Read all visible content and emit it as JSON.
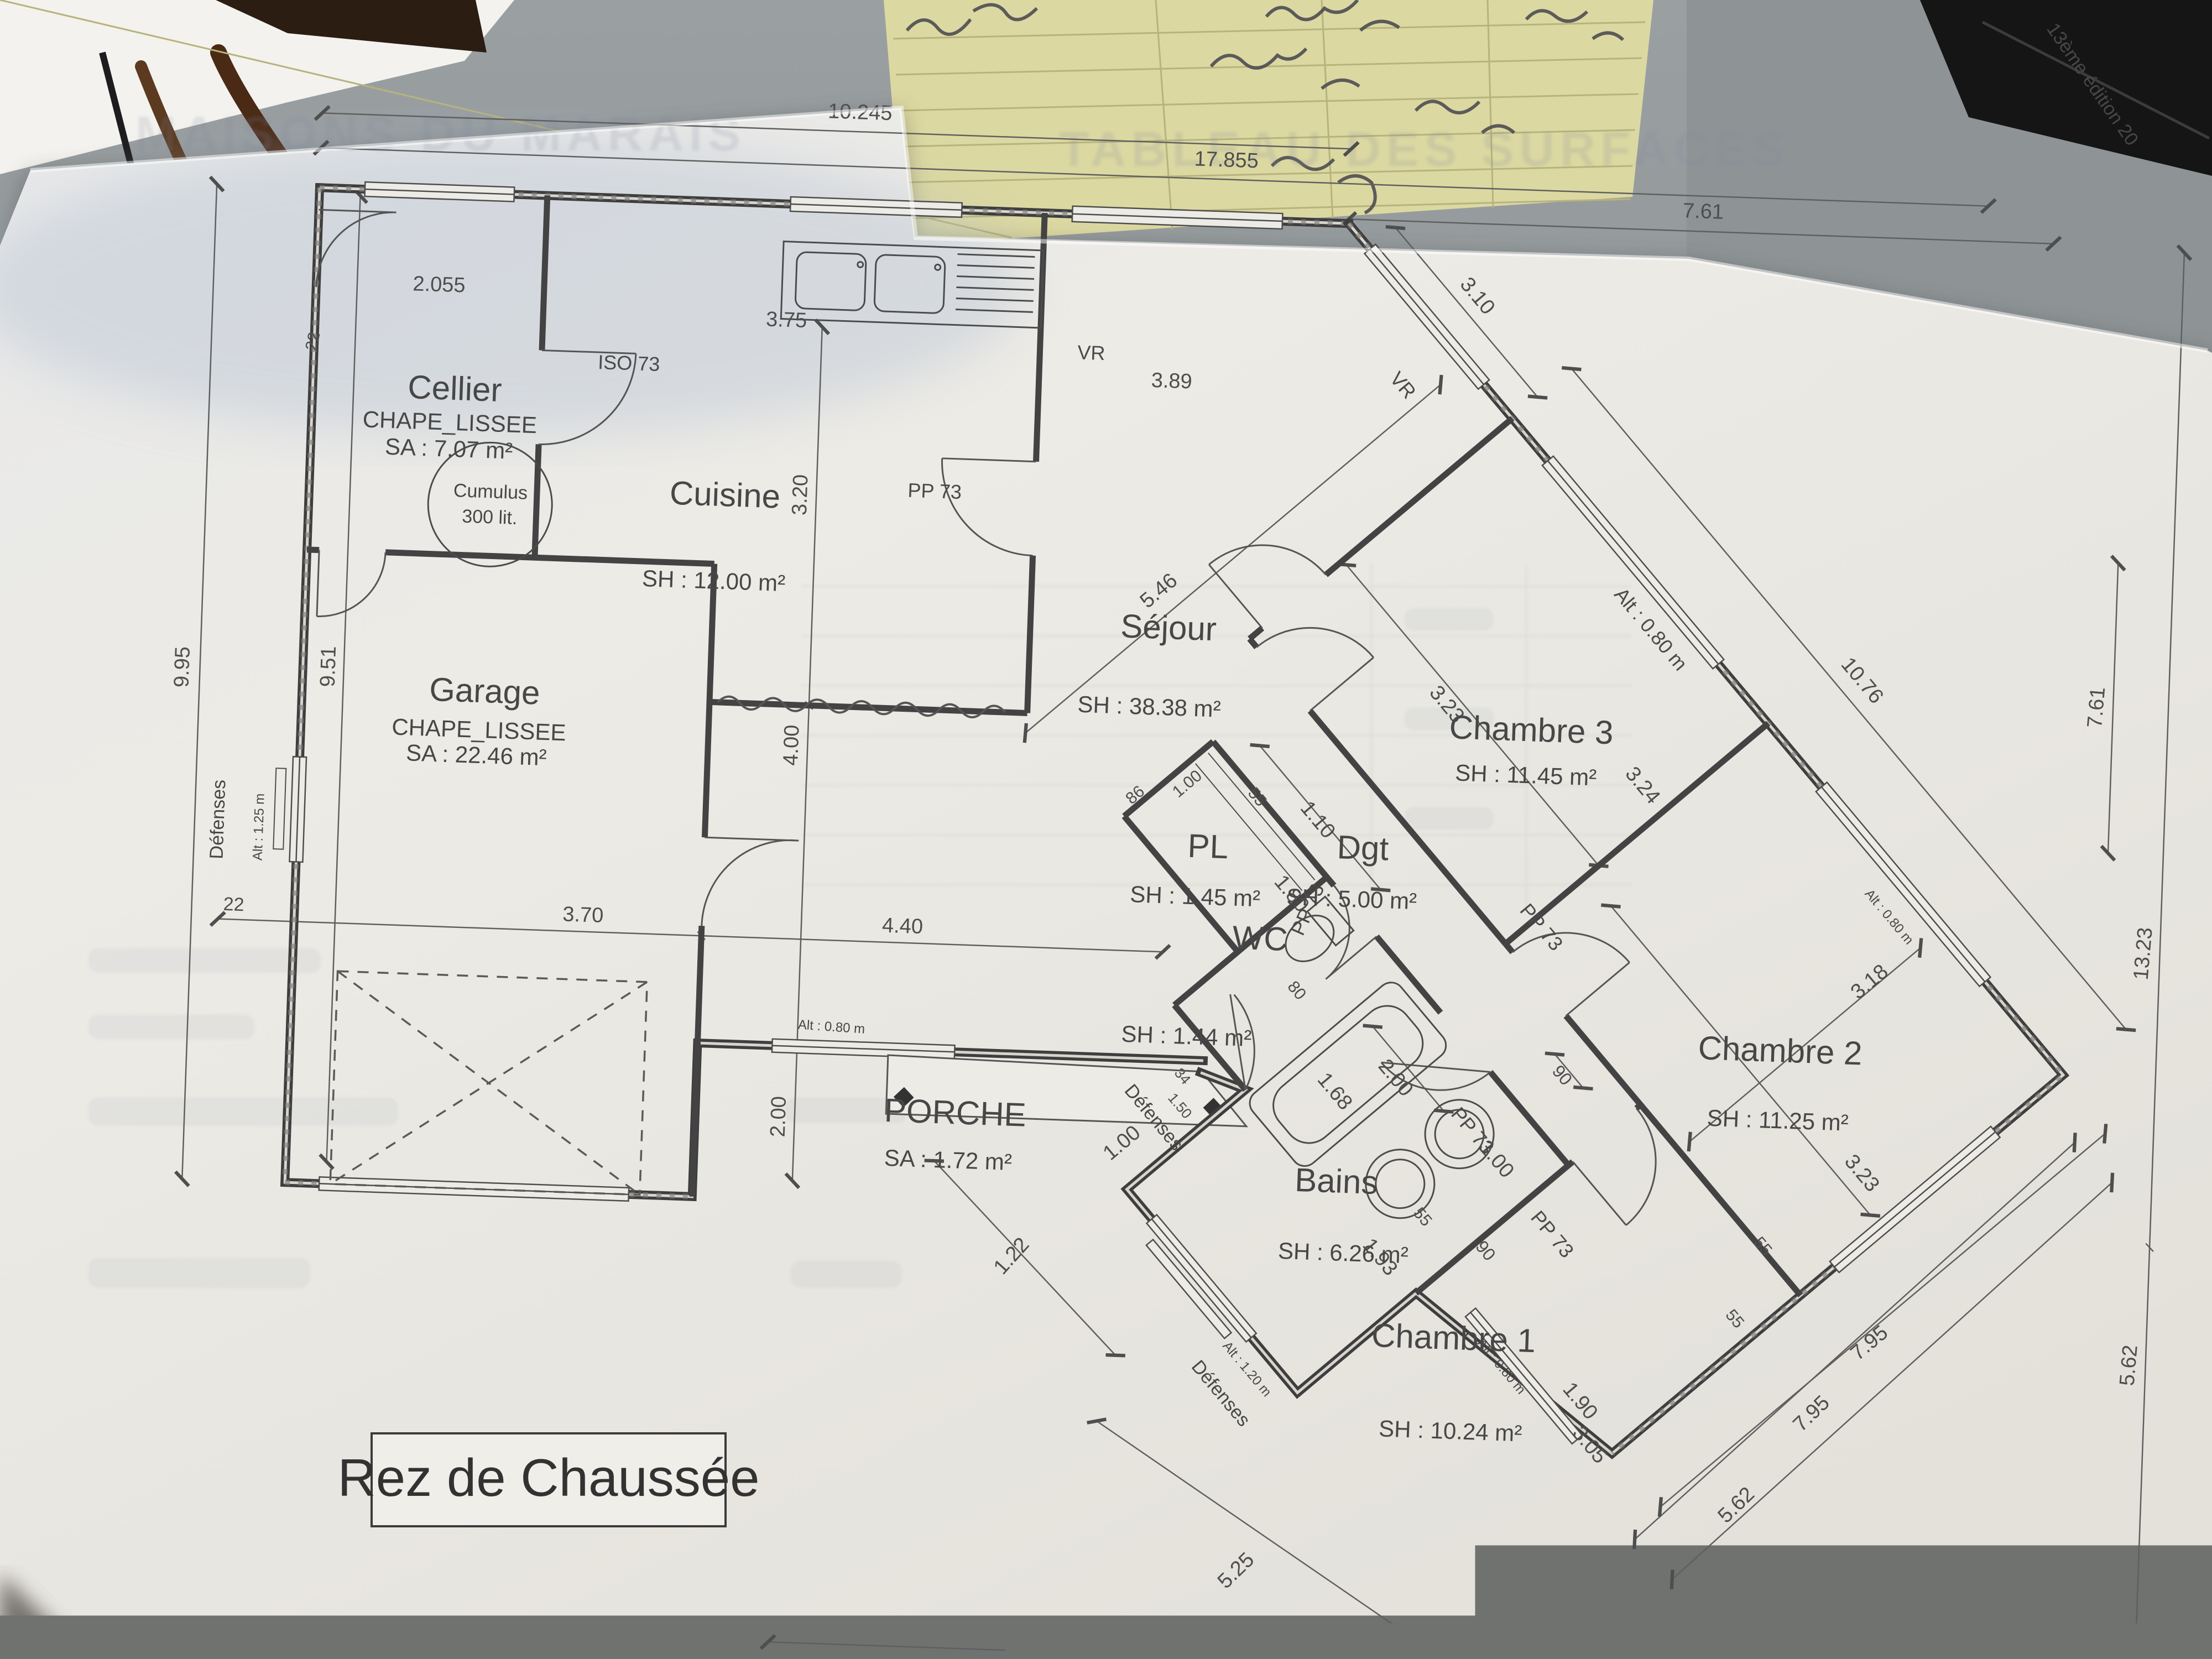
{
  "scene": {
    "bleed_left": "MAISONS DU MARAIS",
    "bleed_right": "TABLEAU DES SURFACES",
    "book_spine": "13ème édition 20"
  },
  "title_box": {
    "label": "Rez de Chaussée"
  },
  "rooms": {
    "cellier": {
      "name": "Cellier",
      "finish": "CHAPE_LISSEE",
      "area": "SA : 7.07 m²"
    },
    "cuisine": {
      "name": "Cuisine",
      "area": "SH : 12.00 m²"
    },
    "sejour": {
      "name": "Séjour",
      "area": "SH : 38.38 m²"
    },
    "garage": {
      "name": "Garage",
      "finish": "CHAPE_LISSEE",
      "area": "SA : 22.46 m²"
    },
    "chambre1": {
      "name": "Chambre 1",
      "area": "SH : 10.24 m²"
    },
    "chambre2": {
      "name": "Chambre 2",
      "area": "SH : 11.25 m²"
    },
    "chambre3": {
      "name": "Chambre 3",
      "area": "SH : 11.45 m²"
    },
    "bains": {
      "name": "Bains",
      "area": "SH : 6.26 m²"
    },
    "wc": {
      "name": "WC",
      "area": "SH : 1.44 m²"
    },
    "pl": {
      "name": "PL",
      "area": "SH : 1.45 m²"
    },
    "dgt": {
      "name": "Dgt",
      "area": "SH : 5.00 m²"
    },
    "porche": {
      "name": "PORCHE",
      "area": "SA : 1.72 m²"
    },
    "cumulus": {
      "line1": "Cumulus",
      "line2": "300 lit."
    }
  },
  "openings": {
    "iso": "ISO 73",
    "pp": "PP 73",
    "vr": "VR",
    "defenses": "Défenses",
    "alt_080": "Alt : 0.80 m",
    "alt_120": "Alt : 1.20 m",
    "alt_125": "Alt : 1.25 m"
  },
  "dims": [
    "10.245",
    "17.855",
    "7.61",
    "9.95",
    "9.51",
    "22",
    "2.055",
    "3.75",
    "3.89",
    "3.20",
    "4.00",
    "2.00",
    "22",
    "3.70",
    "4.40",
    "5.46",
    "3.23",
    "3.24",
    "3.10",
    "10.76",
    "7.61",
    "13.23",
    "5.62",
    "15.5",
    "3.74",
    "5.62",
    "5.62",
    "7.95",
    "5.25",
    "1.10",
    "55",
    "1.00",
    "1.80",
    "86",
    "2.00",
    "1.68",
    "90",
    "1.00",
    "55",
    "1.93",
    "1.00",
    "1.22",
    "34",
    "1.50",
    "80",
    "90",
    "1.90",
    "3.05",
    "55",
    "3.18",
    "3.23",
    "55"
  ]
}
